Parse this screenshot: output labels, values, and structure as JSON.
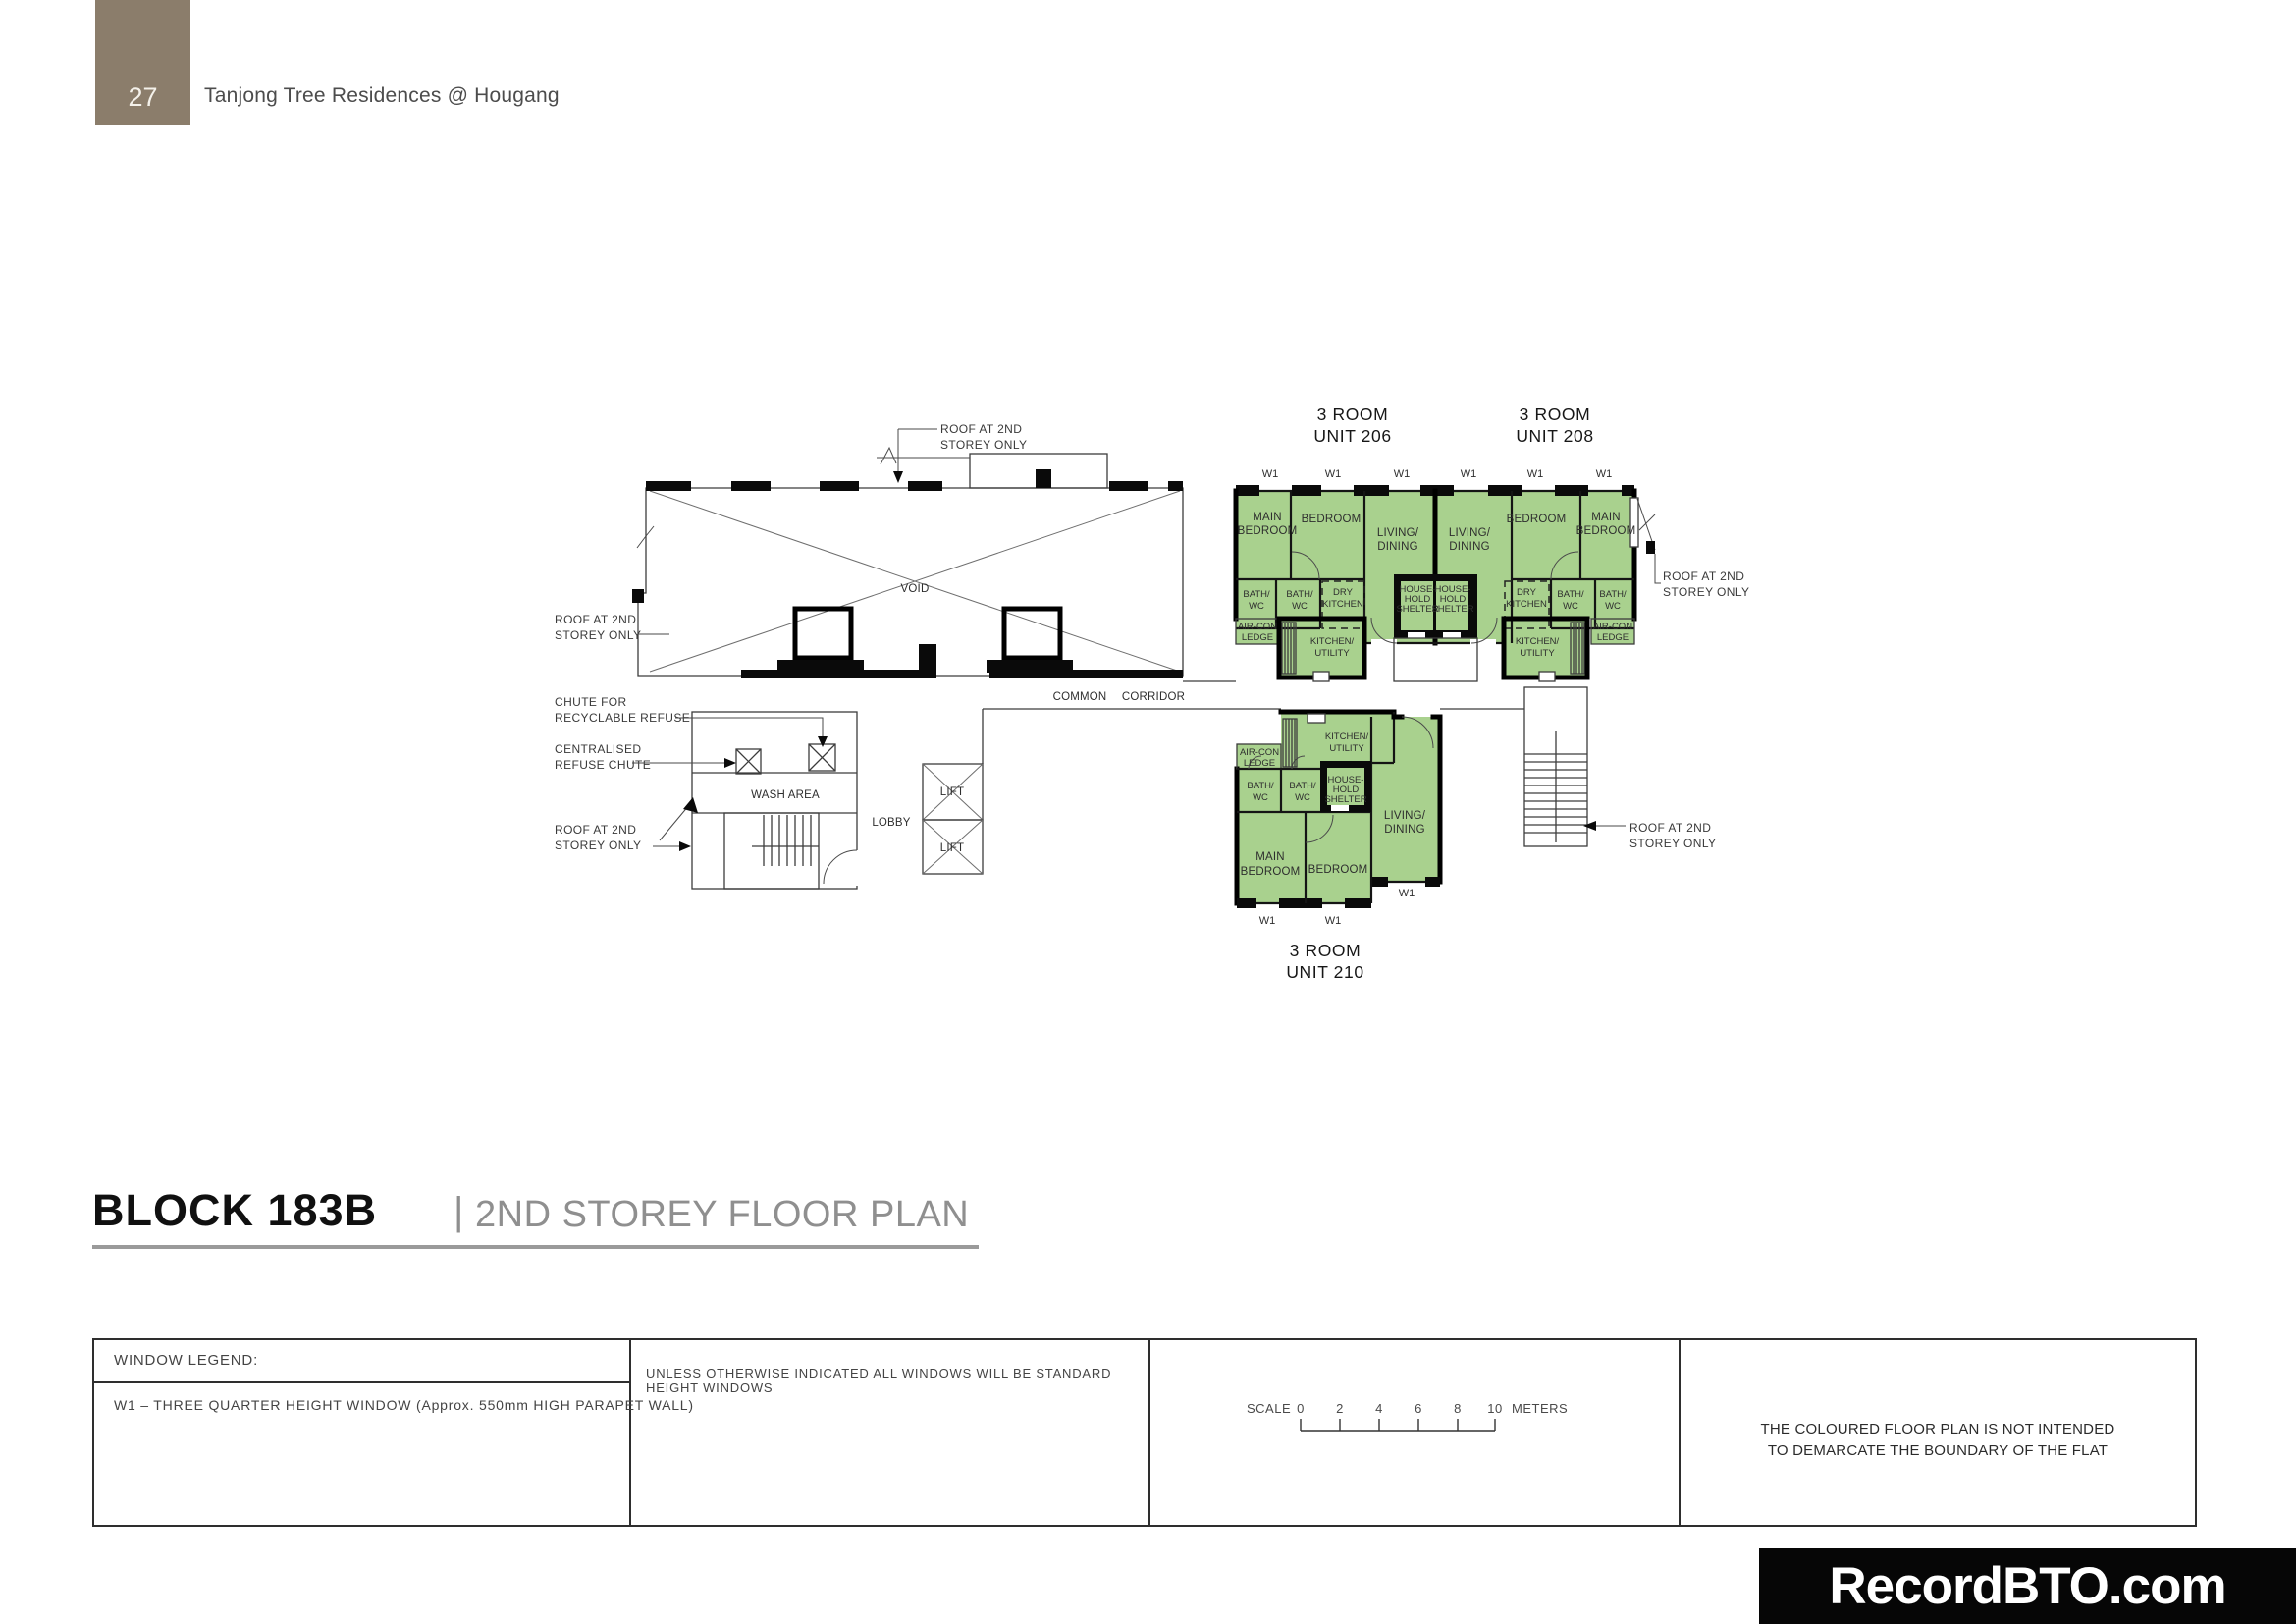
{
  "page": {
    "number": "27",
    "project_title": "Tanjong Tree Residences @ Hougang"
  },
  "plan": {
    "units": {
      "unit206": {
        "line1": "3 ROOM",
        "line2": "UNIT 206"
      },
      "unit208": {
        "line1": "3 ROOM",
        "line2": "UNIT 208"
      },
      "unit210": {
        "line1": "3 ROOM",
        "line2": "UNIT 210"
      }
    },
    "rooms": {
      "main_l1": "MAIN",
      "main_l2": "BEDROOM",
      "bedroom": "BEDROOM",
      "living_l1": "LIVING/",
      "living_l2": "DINING",
      "bath_l1": "BATH/",
      "bath_l2": "WC",
      "dry_l1": "DRY",
      "dry_l2": "KITCHEN",
      "kitchen_l1": "KITCHEN/",
      "kitchen_l2": "UTILITY",
      "hhs_l1": "HOUSE-",
      "hhs_l2": "HOLD",
      "hhs_l3": "SHELTER",
      "aircon_l1": "AIR-CON",
      "aircon_l2": "LEDGE",
      "wash_area": "WASH AREA",
      "lobby": "LOBBY",
      "lift": "LIFT",
      "void": "VOID",
      "corridor_l1": "COMMON",
      "corridor_l2": "CORRIDOR",
      "w1": "W1"
    },
    "annotations": {
      "roof_l1": "ROOF AT 2ND",
      "roof_l2": "STOREY ONLY",
      "chute_l1": "CHUTE FOR",
      "chute_l2": "RECYCLABLE REFUSE",
      "central_l1": "CENTRALISED",
      "central_l2": "REFUSE CHUTE"
    }
  },
  "title": {
    "block": "BLOCK 183B",
    "separator": "|",
    "storey": "2ND STOREY FLOOR PLAN"
  },
  "legend": {
    "window_legend_header": "WINDOW LEGEND:",
    "w1_description": "W1 – THREE QUARTER HEIGHT WINDOW (Approx. 550mm HIGH PARAPET WALL)",
    "windows_note": "UNLESS OTHERWISE INDICATED ALL WINDOWS WILL BE STANDARD HEIGHT WINDOWS",
    "scale": {
      "label": "SCALE",
      "ticks": [
        "0",
        "2",
        "4",
        "6",
        "8",
        "10"
      ],
      "unit": "METERS"
    },
    "disclaimer_l1": "THE COLOURED FLOOR PLAN IS NOT INTENDED",
    "disclaimer_l2": "TO DEMARCATE THE BOUNDARY OF THE FLAT"
  },
  "watermark": "RecordBTO.com",
  "colors": {
    "unit_fill": "#a9d18e",
    "header_box": "#8b7d6b",
    "title_underline": "#9a9a9a",
    "watermark_bg": "#060606"
  }
}
